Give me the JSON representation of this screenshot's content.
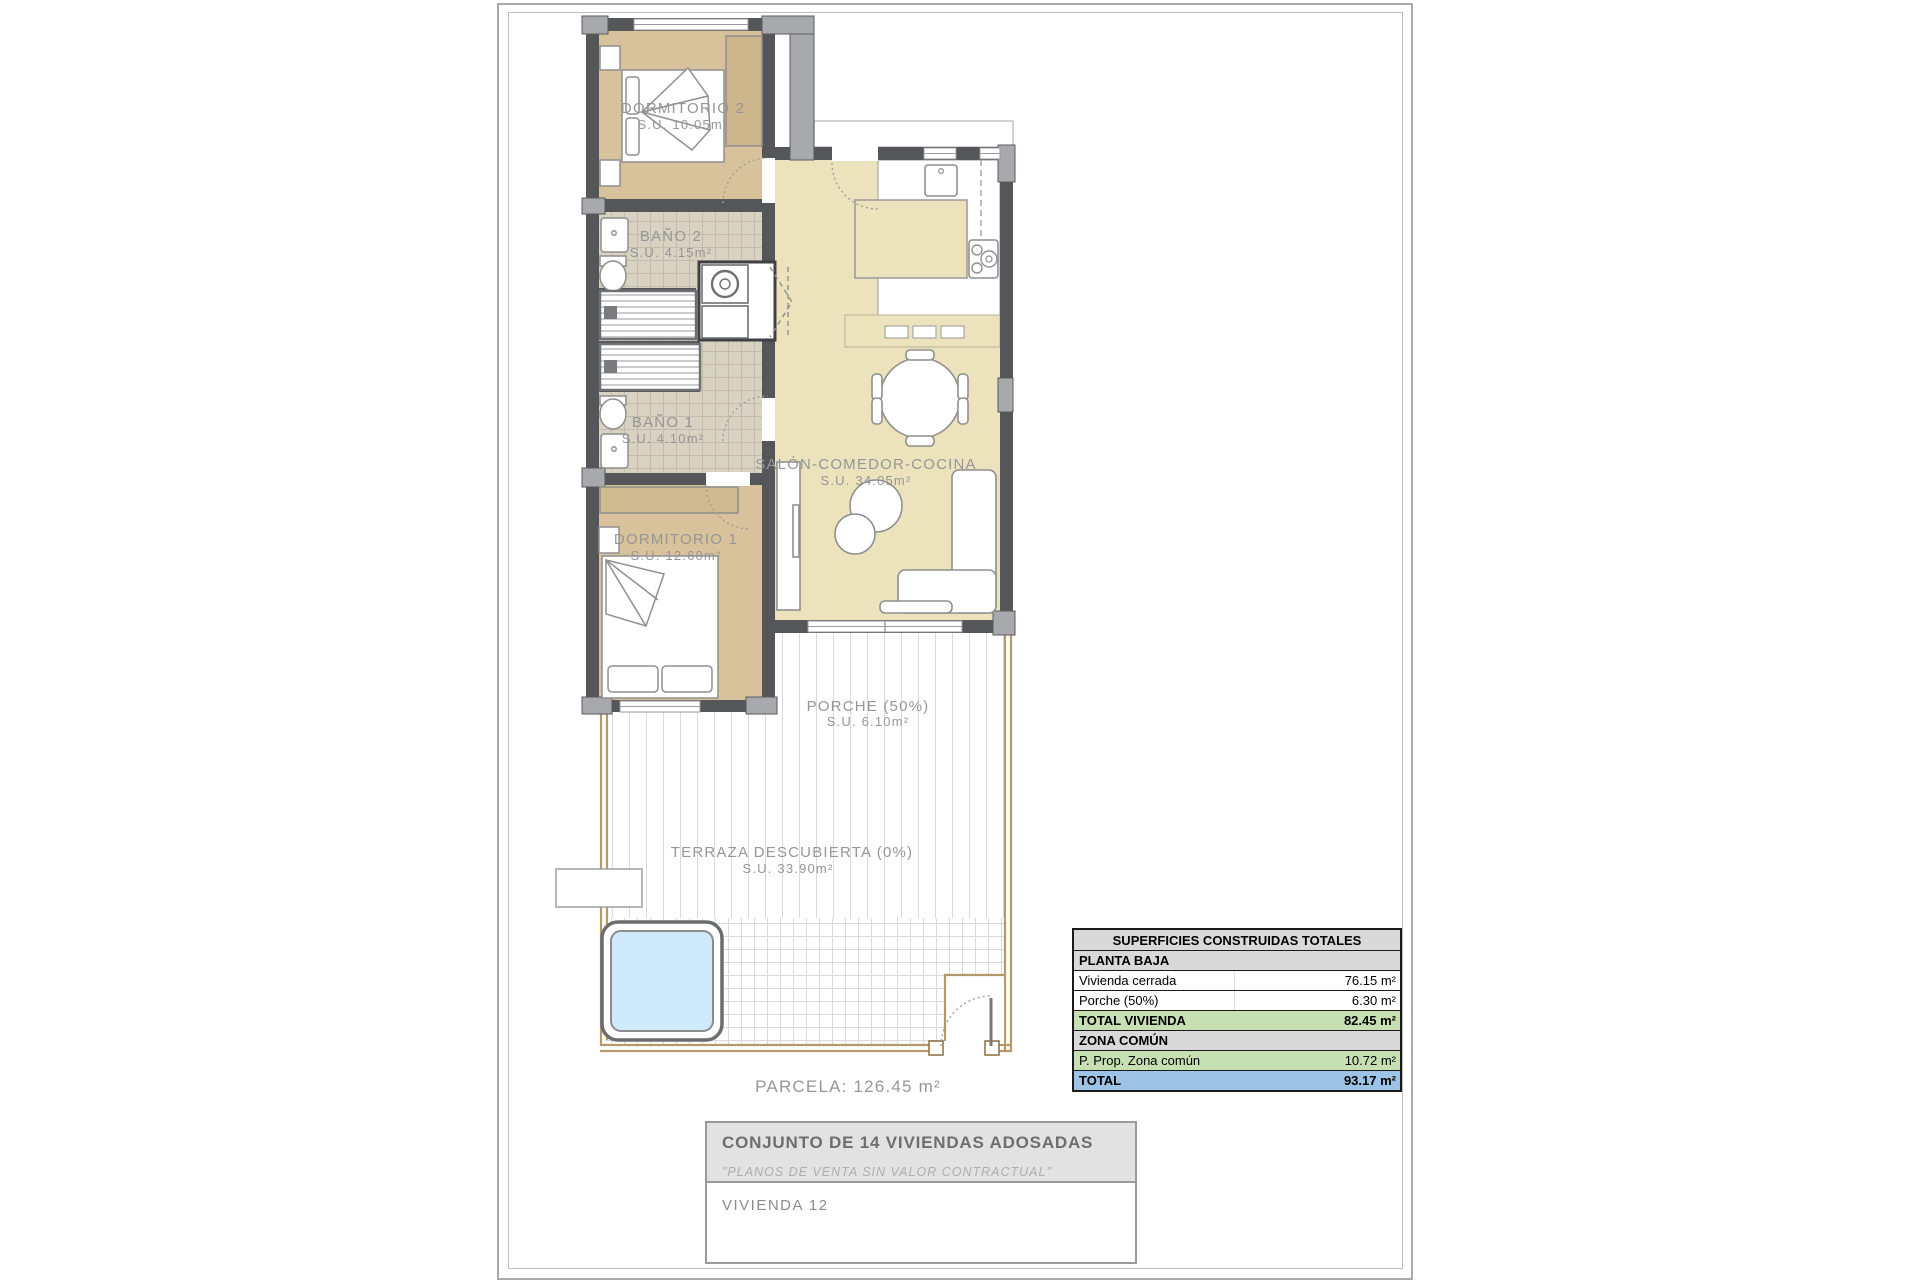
{
  "plan": {
    "rooms": [
      {
        "name": "DORMITORIO 2",
        "area": "S.U. 10.05m²"
      },
      {
        "name": "BAÑO 2",
        "area": "S.U. 4.15m²"
      },
      {
        "name": "BAÑO 1",
        "area": "S.U. 4.10m²"
      },
      {
        "name": "DORMITORIO 1",
        "area": "S.U. 12.60m²"
      },
      {
        "name": "SALÓN-COMEDOR-COCINA",
        "area": "S.U. 34.05m²"
      },
      {
        "name": "PORCHE (50%)",
        "area": "S.U. 6.10m²"
      },
      {
        "name": "TERRAZA DESCUBIERTA (0%)",
        "area": "S.U. 33.90m²"
      }
    ],
    "parcela_label": "PARCELA: 126.45 m²",
    "colors": {
      "wall": "#55565a",
      "pier": "#a8a9ad",
      "salon_floor": "#ece3bd",
      "bedroom_floor": "#d8c29c",
      "bath_tile": "#d8d2c2",
      "pool_water": "#cfeafa",
      "parcela_border": "#b49a66"
    }
  },
  "table": {
    "title": "SUPERFICIES CONSTRUIDAS TOTALES",
    "rows": [
      {
        "label": "PLANTA BAJA",
        "value": ""
      },
      {
        "label": "Vivienda cerrada",
        "value": "76.15 m²"
      },
      {
        "label": "Porche (50%)",
        "value": "6.30 m²"
      },
      {
        "label": "TOTAL VIVIENDA",
        "value": "82.45 m²"
      },
      {
        "label": "ZONA COMÚN",
        "value": ""
      },
      {
        "label": "P. Prop. Zona común",
        "value": "10.72 m²"
      },
      {
        "label": "TOTAL",
        "value": "93.17 m²"
      }
    ],
    "colors": {
      "header": "#d9d9d9",
      "section": "#d9d9d9",
      "subtotal": "#c6e0b4",
      "total": "#9dc3e6"
    }
  },
  "titleblock": {
    "project": "CONJUNTO DE 14 VIVIENDAS ADOSADAS",
    "disclaimer": "\"PLANOS DE VENTA SIN VALOR CONTRACTUAL\"",
    "unit": "VIVIENDA 12"
  }
}
